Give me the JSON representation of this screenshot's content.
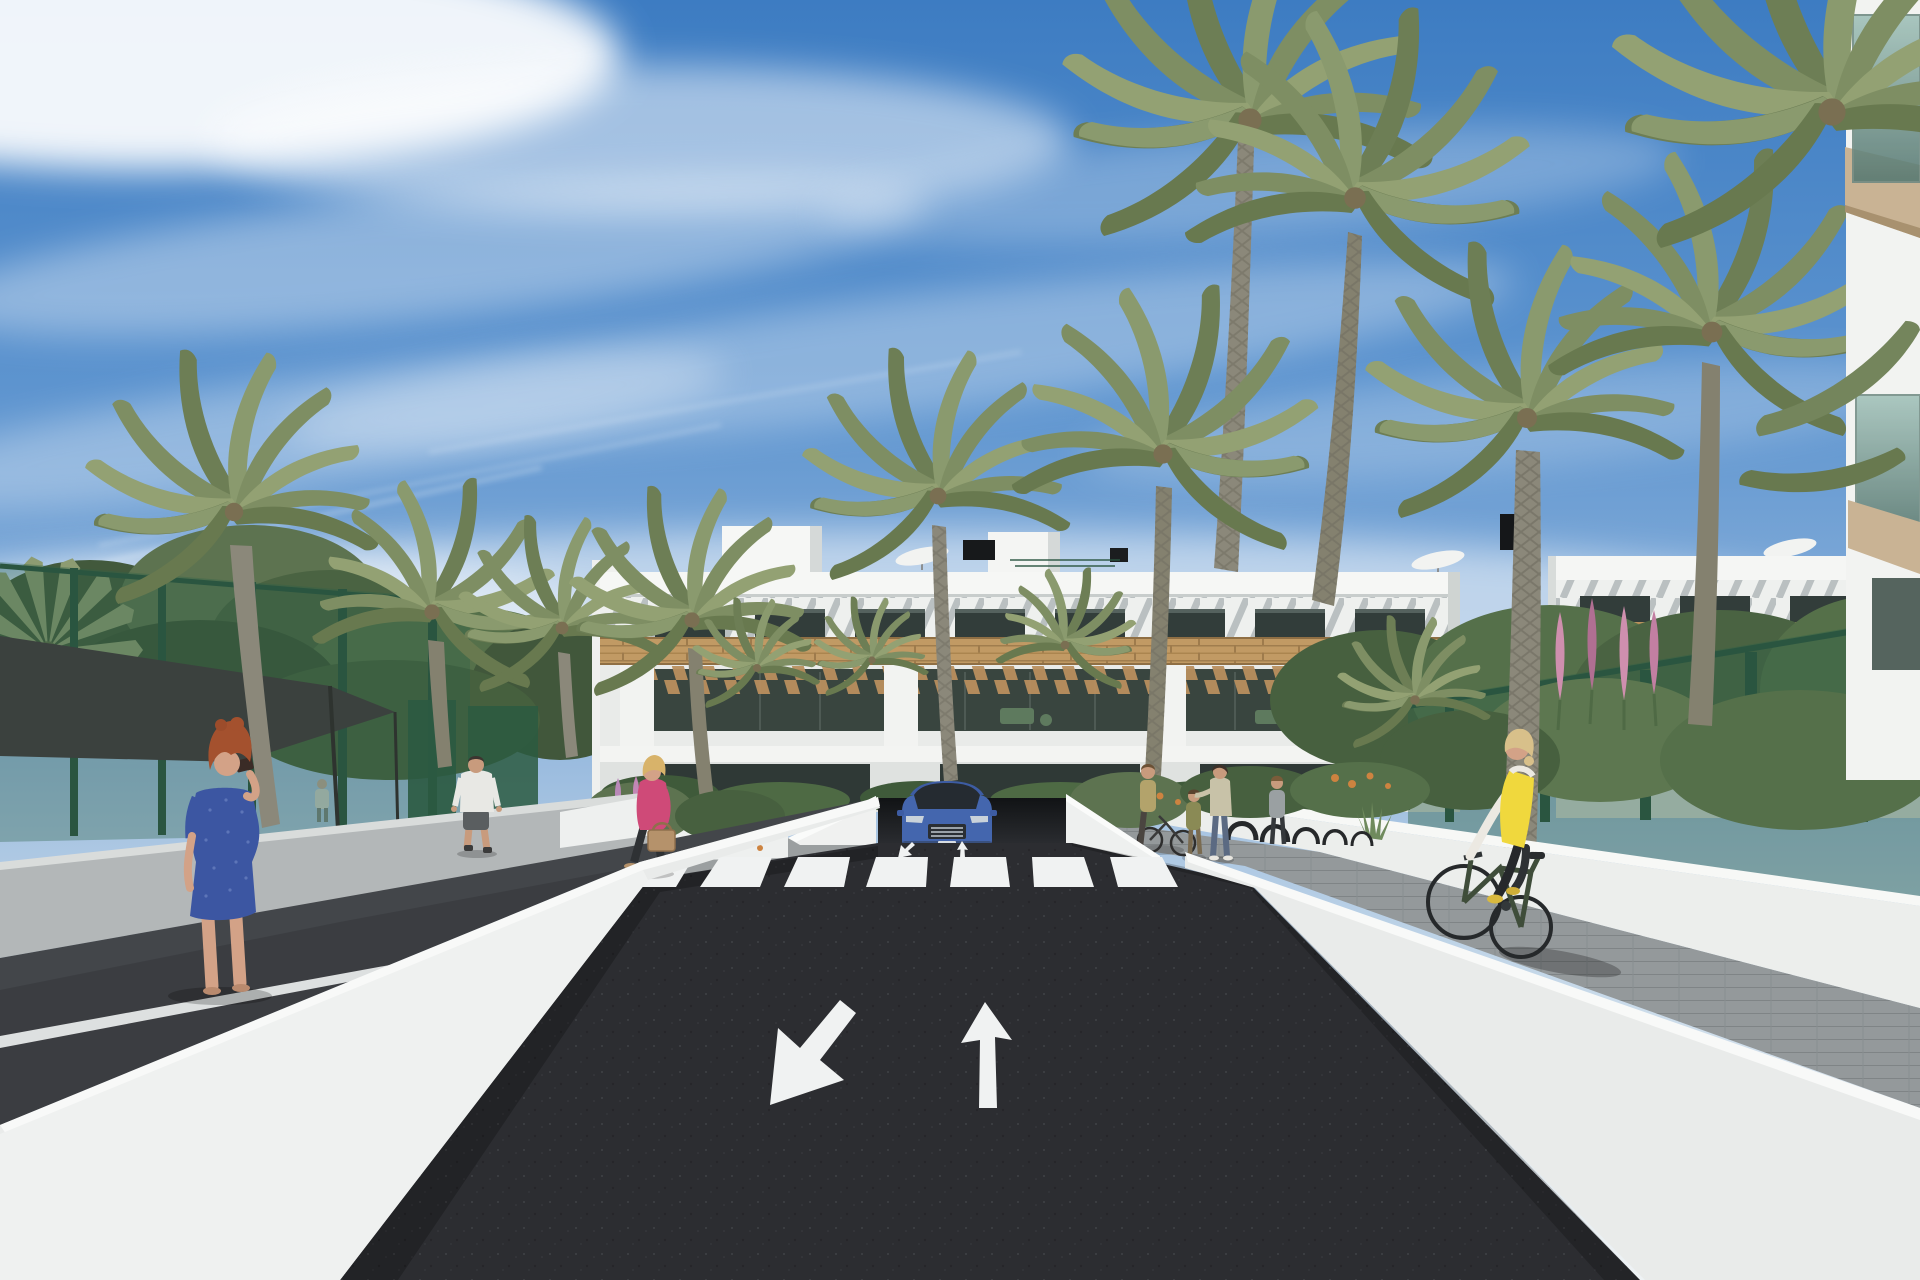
{
  "meta": {
    "title": "Architectural rendering — modern white apartment complex street view",
    "canvas": {
      "width": 1920,
      "height": 1280
    },
    "style": "photoreal 3D visualization, sunny day"
  },
  "palette": {
    "sky_top": "#3d7cc2",
    "sky_mid": "#8fb4dc",
    "sky_low": "#e2eaf0",
    "cloud": "#ffffff",
    "building_white": "#f4f5f3",
    "building_shade": "#d5d9d8",
    "slat_stripe": "#8f999c",
    "window_dark": "#323d3a",
    "wood": "#c19a64",
    "wood_dark": "#9e7b4c",
    "terrace_dark": "#39453f",
    "asphalt": "#2c2d31",
    "road_mark": "#f0f2f2",
    "wall_light": "#f3f4f3",
    "wall_mid": "#e9ebea",
    "wall_shade": "#b3b7b8",
    "path_dark": "#43464a",
    "cobble": "#94999b",
    "fence_green": "#2f6148",
    "screen_green": "#2b5a41",
    "foliage_dark": "#47603f",
    "foliage_mid": "#5d7350",
    "foliage_light": "#7e8f64",
    "palm_green": "#7e8e63",
    "trunk": "#8b887a",
    "flower_pink": "#cf8fae",
    "flower_orange": "#cd8340",
    "flower_violet": "#b989b8",
    "car_blue": "#4466ae",
    "car_glass": "#252b31",
    "vest_yellow": "#f0d83d",
    "dress_blue": "#3c56a2",
    "jacket_pink": "#cf4a78",
    "hair_red": "#a4512e",
    "skin": "#d3a287",
    "sail_dark": "#3b413e",
    "glass_balcony": "#7d9a93",
    "slab_tan": "#c9b394"
  },
  "scene": {
    "sky": {
      "condition": "blue with wispy cirrus clouds and contrails"
    },
    "buildings": {
      "main_block": {
        "floors": 3,
        "features": [
          "white parapet",
          "diagonal louvre band",
          "dark glazing",
          "timber cladding band",
          "timber pergola terraces",
          "roof stair towers",
          "black chimney vents",
          "white roof parasols"
        ]
      },
      "right_block": {
        "floors": 3,
        "features": [
          "same white + timber style",
          "roof parasol",
          "chimney"
        ]
      },
      "foreground_corner": {
        "features": [
          "green glass balconies",
          "tan floor slabs"
        ]
      }
    },
    "road": {
      "surface": "dark asphalt",
      "crosswalk_stripes": 7,
      "lane_arrows": [
        "down-left",
        "up"
      ],
      "edge_lines": 2,
      "ramp": "underground parking entrance"
    },
    "vehicles": [
      {
        "type": "SUV",
        "color": "blue",
        "location": "emerging from parking ramp"
      }
    ],
    "people": [
      {
        "id": "photographer",
        "desc": "red-haired woman in blue dress taking a photo",
        "location": "left walkway"
      },
      {
        "id": "walking-man",
        "desc": "man in white t-shirt and grey shorts",
        "location": "upper left path"
      },
      {
        "id": "pink-jacket-woman",
        "desc": "blonde woman, pink jacket, tan handbag",
        "location": "left sidewalk by planter"
      },
      {
        "id": "bike-woman",
        "desc": "woman standing with bicycle",
        "location": "right sidewalk"
      },
      {
        "id": "child",
        "desc": "small child",
        "location": "right sidewalk"
      },
      {
        "id": "floral-top-woman",
        "desc": "woman in floral top and jeans",
        "location": "right sidewalk"
      },
      {
        "id": "grey-top-woman",
        "desc": "woman near bike racks",
        "location": "right sidewalk"
      },
      {
        "id": "cyclist",
        "desc": "blonde woman, yellow vest, dark green bicycle",
        "location": "right path riding away"
      },
      {
        "id": "distant-pedestrian",
        "desc": "faint figure behind fence",
        "location": "far left garden"
      }
    ],
    "vegetation": {
      "palm_trees": 14,
      "canopy_trees": 3,
      "flower_colors": [
        "pink",
        "orange",
        "violet"
      ]
    },
    "street_furniture": [
      "green mesh fence",
      "dark green privacy screens",
      "shade sail",
      "bicycle racks",
      "white planter walls"
    ]
  }
}
